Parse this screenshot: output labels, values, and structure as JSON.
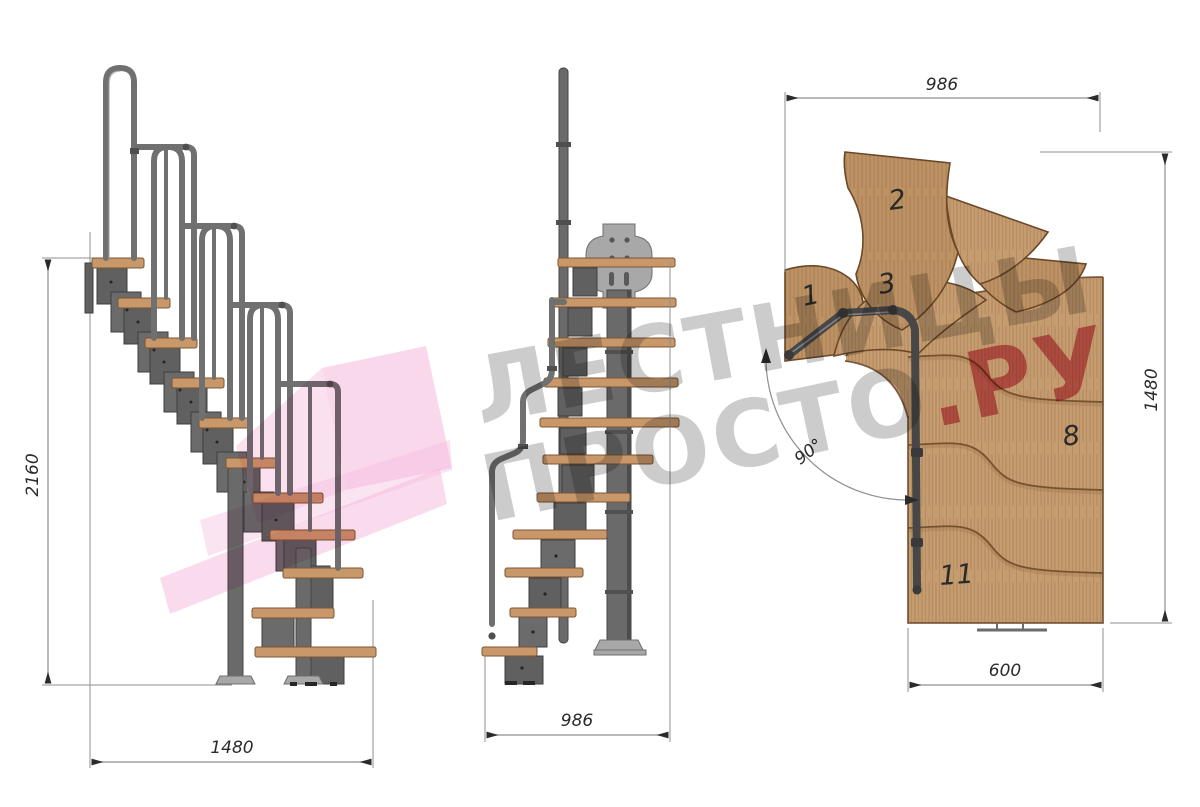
{
  "watermark": {
    "line1": "ЛЕСТНИЦЫ",
    "line2_gray": "ПРОСТО",
    "line2_pink": ".РУ"
  },
  "dimensions": {
    "side_height": "2160",
    "side_run": "1480",
    "front_width": "986",
    "plan_width": "986",
    "plan_depth": "1480",
    "plan_flight_width": "600",
    "plan_turn_angle": "90°"
  },
  "plan_step_numbers": {
    "s1": "1",
    "s2": "2",
    "s3": "3",
    "s8": "8",
    "s11": "11"
  },
  "colors": {
    "wood": "#c59c6f",
    "wood2": "#bd9264",
    "tread": "#c9986a",
    "treadEdge": "#7c5533",
    "woodLine": "#6b4828",
    "metal": "#606060",
    "metalDark": "#3e3e3e",
    "rail": "#707070",
    "plate": "#a8a8a8",
    "dim": "#8f8f8f",
    "ink": "#2b2b2b",
    "wmGray": "#adadad",
    "wmPink": "#d55a75",
    "arrowPink": "#f5b8dc"
  }
}
